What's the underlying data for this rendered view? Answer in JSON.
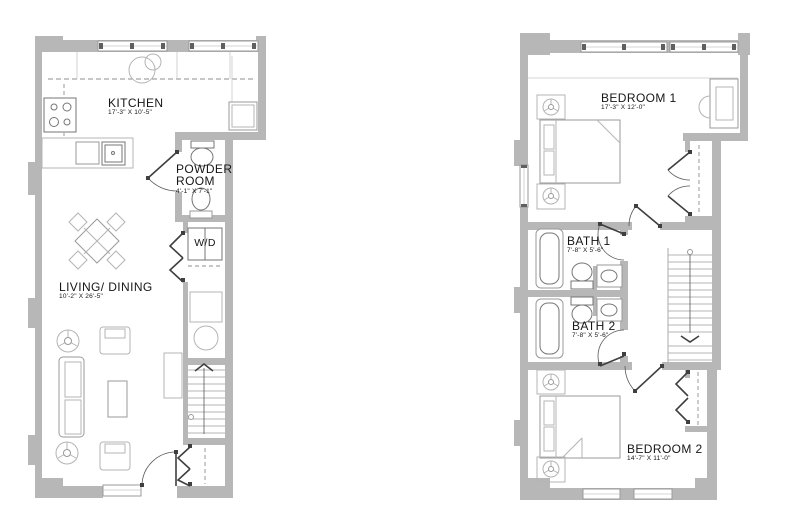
{
  "colors": {
    "background": "#ffffff",
    "wall": "#b7b7b7",
    "furniture_line": "#9a9a9a",
    "fixture_line": "#767676",
    "door_line": "#3f3f3f",
    "text": "#161616"
  },
  "floor1": {
    "rooms": {
      "kitchen": {
        "label": "KITCHEN",
        "dims": "17'-3\" X 10'-5\""
      },
      "powder_room": {
        "label": "POWDER ROOM",
        "dims": "4'-1\" X 7'-1\""
      },
      "washer_dryer": {
        "label": "W/D"
      },
      "living_dining": {
        "label": "LIVING/ DINING",
        "dims": "10'-2\" X 26'-5\""
      }
    }
  },
  "floor2": {
    "rooms": {
      "bedroom1": {
        "label": "BEDROOM 1",
        "dims": "17'-3\" X 12'-0\""
      },
      "bath1": {
        "label": "BATH 1",
        "dims": "7'-8\" X 5'-6\""
      },
      "bath2": {
        "label": "BATH 2",
        "dims": "7'-8\" X 5'-6\""
      },
      "bedroom2": {
        "label": "BEDROOM 2",
        "dims": "14'-7\" X 11'-0\""
      }
    }
  }
}
